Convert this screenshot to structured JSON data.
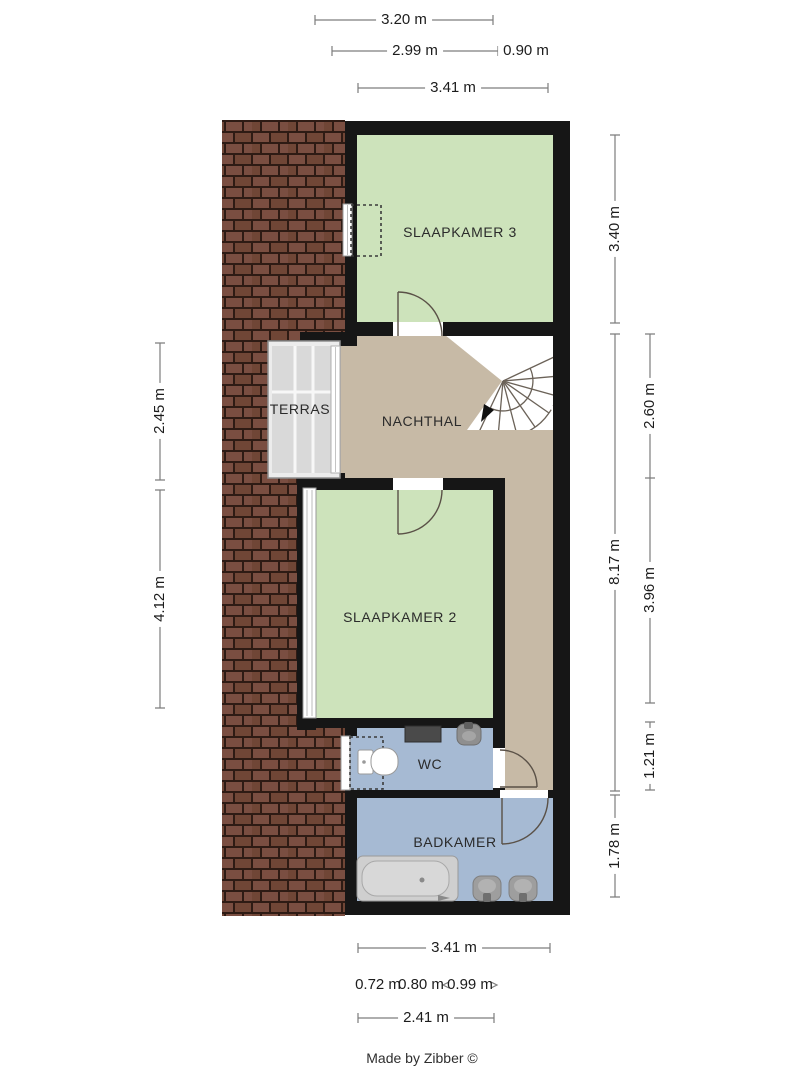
{
  "credit": "Made by Zibber ©",
  "rooms": {
    "slaapkamer3": "SLAAPKAMER 3",
    "nachthal": "NACHTHAL",
    "terras": "TERRAS",
    "slaapkamer2": "SLAAPKAMER 2",
    "wc": "WC",
    "badkamer": "BADKAMER"
  },
  "dimensions": {
    "top": [
      "3.20 m",
      "2.99 m",
      "0.90 m",
      "3.41 m"
    ],
    "right_outer": [
      "3.40 m",
      "8.17 m",
      "1.78 m"
    ],
    "right_inner": [
      "2.60 m",
      "3.96 m",
      "1.21 m"
    ],
    "left": [
      "2.45 m",
      "4.12 m"
    ],
    "bottom_total": "3.41 m",
    "bottom_segments": [
      "0.72 m",
      "0.80 m",
      "0.99 m"
    ],
    "bottom_partial": "2.41 m"
  },
  "fixtures": [
    "spiral-staircase",
    "toilet",
    "radiator",
    "wash-basin",
    "bathtub",
    "terrace-decking",
    "dormer-window"
  ],
  "colors": {
    "room_green": "#cde3bb",
    "hall_beige": "#c7baa6",
    "wet_blue": "#a6bad3",
    "terrace_grey": "#d9d9d9",
    "wall_black": "#161616",
    "roof_tile": "#7a4e41",
    "roof_tile_dark": "#704636",
    "roof_grout": "#2e1b14",
    "dim_line": "#7d7d7d"
  }
}
